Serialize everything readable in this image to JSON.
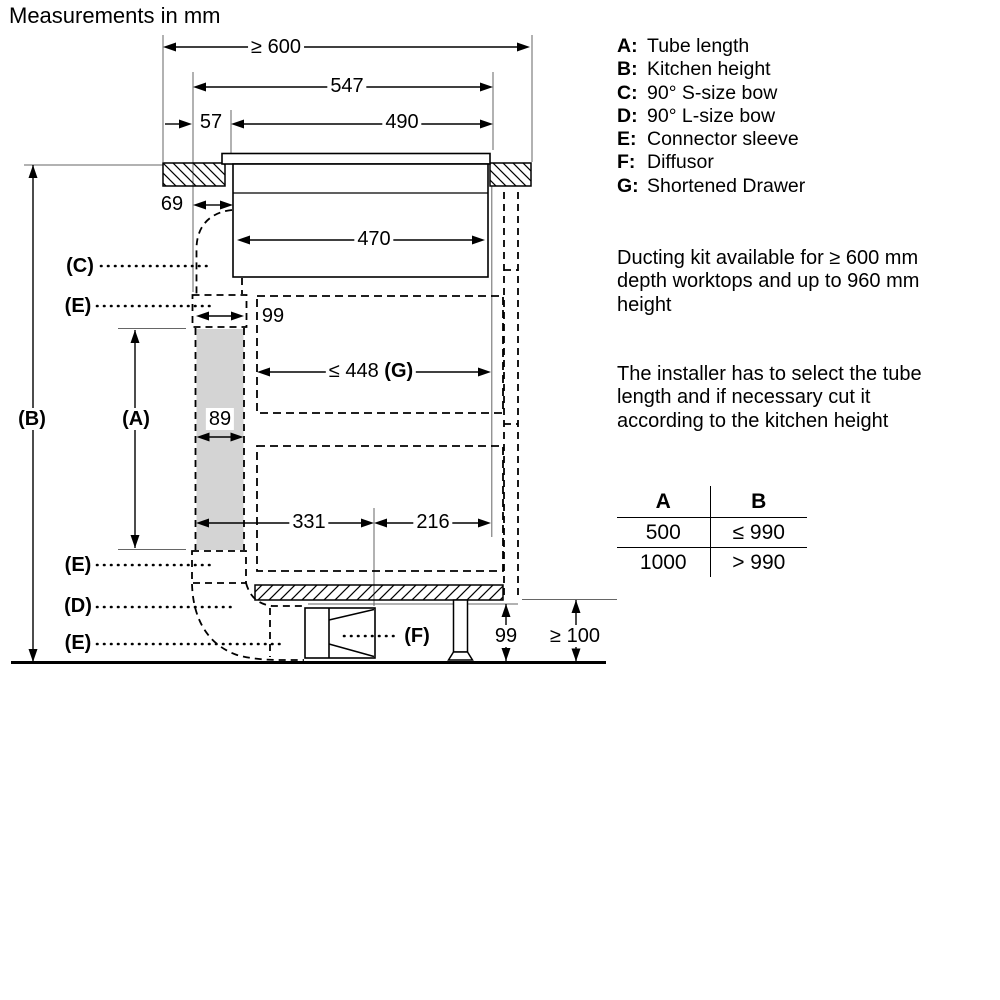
{
  "title": "Measurements in mm",
  "colors": {
    "ink": "#000000",
    "tube_fill": "#d4d4d4"
  },
  "diagram": {
    "dims": {
      "worktop_depth": "≥ 600",
      "hob_total_depth": "547",
      "front_offset": "57",
      "cutout_depth": "490",
      "outlet_offset": "69",
      "hob_body_depth": "470",
      "sleeve_width": "99",
      "drawer_depth": "≤ 448",
      "drawer_ref": "(G)",
      "tube_width": "89",
      "front_depth": "331",
      "back_depth": "216",
      "diffusor_height": "99",
      "floor_clearance": "≥ 100"
    },
    "refs": {
      "a": "(A)",
      "b": "(B)",
      "c": "(C)",
      "d": "(D)",
      "e_top": "(E)",
      "e_mid": "(E)",
      "e_bottom": "(E)",
      "f": "(F)"
    }
  },
  "legend": {
    "items": [
      {
        "key": "A:",
        "label": "Tube length"
      },
      {
        "key": "B:",
        "label": "Kitchen height"
      },
      {
        "key": "C:",
        "label": "90° S-size bow"
      },
      {
        "key": "D:",
        "label": "90° L-size bow"
      },
      {
        "key": "E:",
        "label": "Connector sleeve"
      },
      {
        "key": "F:",
        "label": "Diffusor"
      },
      {
        "key": "G:",
        "label": "Shortened Drawer"
      }
    ]
  },
  "notes": [
    {
      "lines": [
        "Ducting kit available for ≥ 600 mm",
        "depth worktops and up to 960 mm",
        "height"
      ]
    },
    {
      "lines": [
        "The installer has to select the tube",
        "length and if necessary cut it",
        "according to the kitchen height"
      ]
    }
  ],
  "table": {
    "headers": [
      "A",
      "B"
    ],
    "rows": [
      [
        "500",
        "≤ 990"
      ],
      [
        "1000",
        "> 990"
      ]
    ]
  }
}
